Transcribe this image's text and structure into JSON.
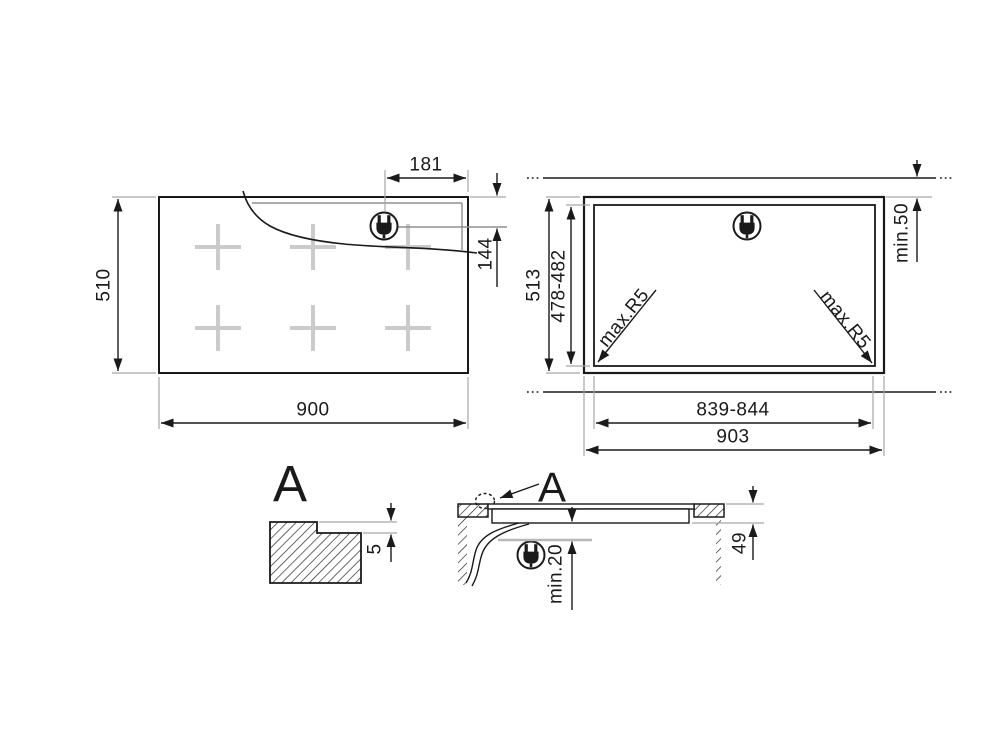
{
  "colors": {
    "ink": "#1a1a1a",
    "extension_line": "#a6a6a6",
    "zone_marker": "#cbcbcb",
    "shelf_line": "#b8b8b8",
    "background": "#ffffff"
  },
  "icons": {
    "power_plug": "power-plug-icon"
  },
  "top_view": {
    "height": "510",
    "width": "900",
    "plug_from_right": "181",
    "plug_from_top": "144"
  },
  "cutout_view": {
    "worktop_depth": "513",
    "cutout_depth": "478-482",
    "cutout_width": "839-844",
    "worktop_width": "903",
    "rear_clearance": "min.50",
    "corner_radius_left": "max.R5",
    "corner_radius_right": "max.R5"
  },
  "detail_view": {
    "label": "A",
    "recess_depth": "5"
  },
  "section_view": {
    "detail_label": "A",
    "clearance_below": "min.20",
    "body_height": "49"
  }
}
